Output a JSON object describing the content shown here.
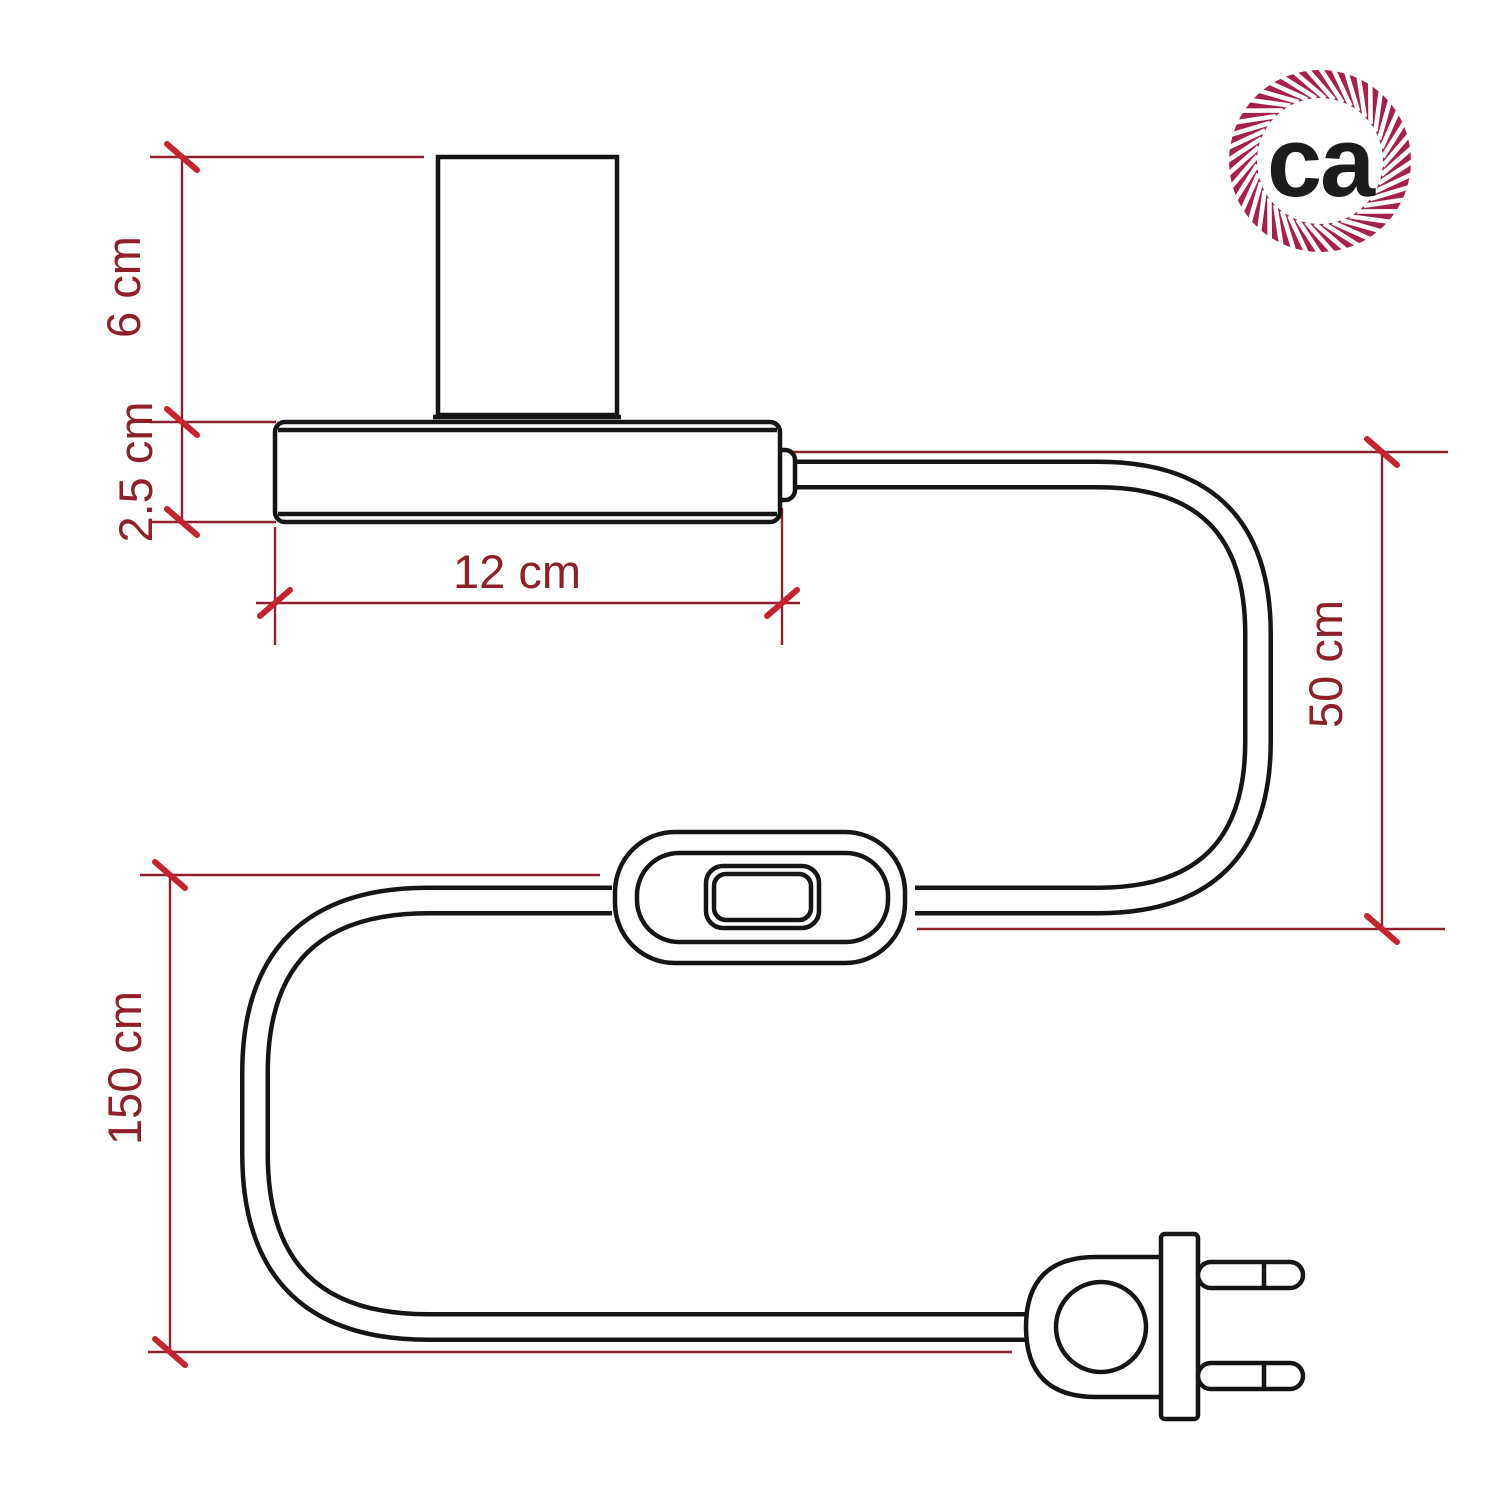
{
  "page": {
    "background": "#ffffff"
  },
  "logo": {
    "text": "ca",
    "rope_color": "#a6204a",
    "text_color": "#1c1c1a"
  },
  "drawing": {
    "line_color": "#151515",
    "dimension_line_color": "#8d2130",
    "tick_color": "#c5242e",
    "label_color": "#8e1f2b"
  },
  "dimensions": {
    "socket_height": {
      "label": "6 cm"
    },
    "base_thickness": {
      "label": "2.5 cm"
    },
    "base_width": {
      "label": "12 cm"
    },
    "cable_lamp_to_switch": {
      "label": "50 cm"
    },
    "cable_switch_to_plug": {
      "label": "150 cm"
    }
  }
}
